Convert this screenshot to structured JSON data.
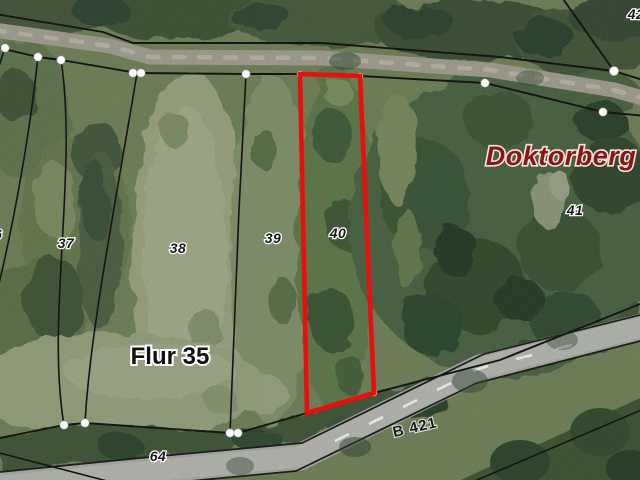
{
  "map": {
    "labels": {
      "flur": "Flur 35",
      "place": "Doktorberg",
      "road": "B 421",
      "p36": "36",
      "p37": "37",
      "p38": "38",
      "p39": "39",
      "p40": "40",
      "p41": "41",
      "p42": "42",
      "p64": "64"
    },
    "highlighted_parcel": "40",
    "colors": {
      "highlight_outline": "#e8100f",
      "place_text": "#8c1616",
      "boundary_line": "#151515",
      "vertex_dot": "#ffffff",
      "road_surface": "#a7aaa3",
      "track_surface": "#a09e90"
    }
  }
}
